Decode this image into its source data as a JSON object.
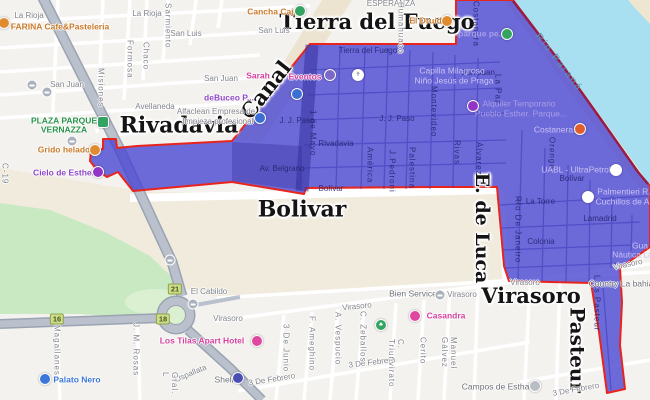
{
  "annotations": {
    "tierra": "Tierra del Fuego",
    "canal": "Canal",
    "rivadavia": "Rivadavia",
    "bolivar": "Bolivar",
    "de_luca": "E. de Luca",
    "virasoro": "Virasoro",
    "pasteur": "Pasteur"
  },
  "water_label": "Río Paraná",
  "route_shields": {
    "r16": "16",
    "r18": "18",
    "r21": "21"
  },
  "streets": {
    "la_rioja": "La Rioja",
    "san_luis": "San Luis",
    "san_juan": "San Juan",
    "sarmiento": "Sarmiento",
    "formosa": "Formosa",
    "chaco": "Chaco",
    "misiones": "Misiones",
    "avellaneda": "Avellaneda",
    "c19": "C-19",
    "humahuaca": "Humahuaca",
    "costanera": "Costanera",
    "la_paz": "La Paz",
    "montevideo": "Montevideo",
    "uno_de_mayo": "1 de Mayo",
    "america": "América",
    "j_pedroni": "J.Pedroni",
    "palestina": "Palestina",
    "rivas": "Rivas",
    "alvarez": "Álvarez",
    "orengo": "Orengo",
    "rio_de_janeiro": "Río De Janeiro",
    "luis_pasteur": "Luis Pasteur",
    "tierra_del_fuego": "Tierra del Fuego",
    "j_j_paso": "J. J. Paso",
    "rivadavia": "Rivadavia",
    "av_belgrano": "Av. Belgrano",
    "bolivar": "Bolívar",
    "l_la_torre": "L. La Torre",
    "lamadrid": "Lamadrid",
    "colonia": "Colonia",
    "virasoro": "Virasoro",
    "tres_de_febrero": "3 De Febrero",
    "tres_de_junio": "3 De Junio",
    "ameghino": "F. Ameghino",
    "vespucio": "A. Vespucio",
    "zeballos": "C. Zeballos",
    "triunvirato": "C. Triunvirato",
    "cerito": "Cerito",
    "uspallata": "Uspallata",
    "magallanes": "Magallanes",
    "jm_rosas": "J. M. Rosas",
    "manuel_galvez": "Manuel Gálvez",
    "gral": "Gral. L",
    "esperanza": "ESPERANZA",
    "el_cabildo": "El Cabildo"
  },
  "pois": {
    "farina": "FARINA Cafe&Pasteleria",
    "cancha_caju": "Cancha Caju",
    "el_druida": "El Druida",
    "sarah": "Sarah",
    "eventos": "Eventos",
    "debuceo": "deBuceo P...",
    "alfaclean_1": "Alfaclean Empresa de",
    "alfaclean_2": "limpieza profesional",
    "plaza_1": "PLAZA PARQUE",
    "plaza_2": "VERNAZZA",
    "grido": "Grido helado",
    "cielo": "Cielo de Esther",
    "parque_pe": "parque pe...",
    "capilla_1": "Capilla Milagroso",
    "capilla_2": "Niño Jesús de Praga",
    "alquiler_1": "Alquiler Temporario",
    "alquiler_2": "Pueblo Esther. Parque...",
    "costanera_poi": "Costanera...",
    "uabl": "UABL - UltraPetrol",
    "palmentieri_1": "Palmentieri R.",
    "palmentieri_2": "Cuchillos de A...",
    "gua_1": "Gua",
    "gua_2": "Náutica La...",
    "country": "Country La bahia",
    "bien_service": "Bien Service",
    "casandra": "Casandra",
    "los_tilas": "Los Tilas Apart Hotel",
    "shell": "Shell",
    "palato": "Palato Nero",
    "campos": "Campos de Esthar"
  },
  "colors": {
    "highlight_fill": "#4a46d2",
    "highlight_border": "#e8251d",
    "shore_border": "#8c1a4b",
    "water": "#a8e0f1",
    "park": "#c9e9c2",
    "terrain_tan": "#f0ebdc",
    "highway": "#bac1cd",
    "poi_orange": "#c97a2a",
    "poi_pink": "#d4409f",
    "poi_purple": "#8f47c9",
    "poi_green": "#27934b",
    "poi_blue": "#3b76d8"
  }
}
